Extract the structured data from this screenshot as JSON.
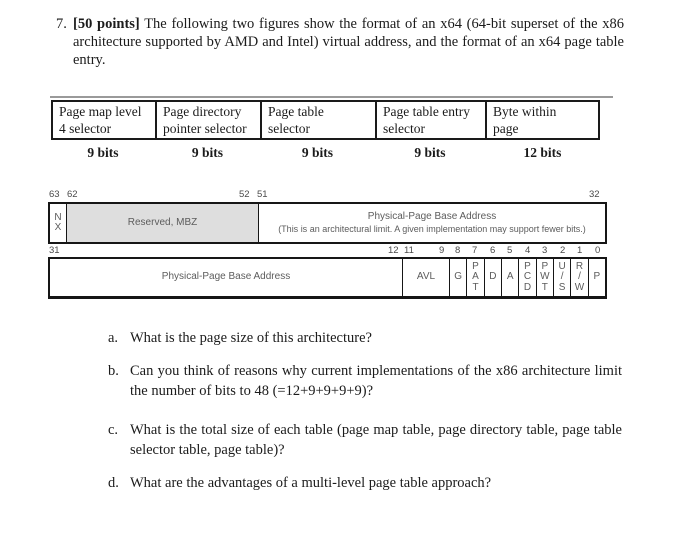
{
  "colors": {
    "reserved_fill": "#dedede",
    "diagram_text": "#5c5c5c",
    "border": "#161616"
  },
  "question": {
    "number": "7.",
    "points_label": "[50 points]",
    "body": "The following two figures show the format of an x64 (64-bit superset of the x86 architecture supported by AMD and Intel) virtual address, and the format of an x64 page table entry."
  },
  "va_table": {
    "columns": [
      {
        "label": "Page map level\n4 selector",
        "bits": "9 bits"
      },
      {
        "label": "Page directory\npointer selector",
        "bits": "9 bits"
      },
      {
        "label": "Page table\nselector",
        "bits": "9 bits"
      },
      {
        "label": "Page table entry\nselector",
        "bits": "9 bits"
      },
      {
        "label": "Byte within\npage",
        "bits": "12 bits"
      }
    ]
  },
  "pte": {
    "row1": {
      "bit_labels": {
        "b63": "63",
        "b62": "62",
        "b52": "52",
        "b51": "51",
        "b32": "32"
      },
      "nx": "N\nX",
      "reserved": "Reserved, MBZ",
      "ppba_title": "Physical-Page Base Address",
      "ppba_note": "(This is an architectural limit. A given implementation may support fewer bits.)"
    },
    "row2": {
      "bit_labels": {
        "b31": "31",
        "b12": "12",
        "b11": "11",
        "b9": "9",
        "b8": "8",
        "b7": "7",
        "b6": "6",
        "b5": "5",
        "b4": "4",
        "b3": "3",
        "b2": "2",
        "b1": "1",
        "b0": "0"
      },
      "ppba": "Physical-Page Base Address",
      "avl": "AVL",
      "g": "G",
      "pat": "P\nA\nT",
      "d": "D",
      "a": "A",
      "pcd": "P\nC\nD",
      "pwt": "P\nW\nT",
      "us": "U\n/\nS",
      "rw": "R\n/\nW",
      "p": "P"
    }
  },
  "subquestions": [
    {
      "marker": "a.",
      "text": "What is the page size of this architecture?"
    },
    {
      "marker": "b.",
      "text": "Can you think of reasons why current implementations of the x86 architecture limit the number of bits to 48 (=12+9+9+9+9)?"
    },
    {
      "marker": "c.",
      "text": "What is the total size of each table (page map table, page directory table, page table selector table, page table)?"
    },
    {
      "marker": "d.",
      "text": "What are the advantages of a multi-level page table approach?"
    }
  ]
}
